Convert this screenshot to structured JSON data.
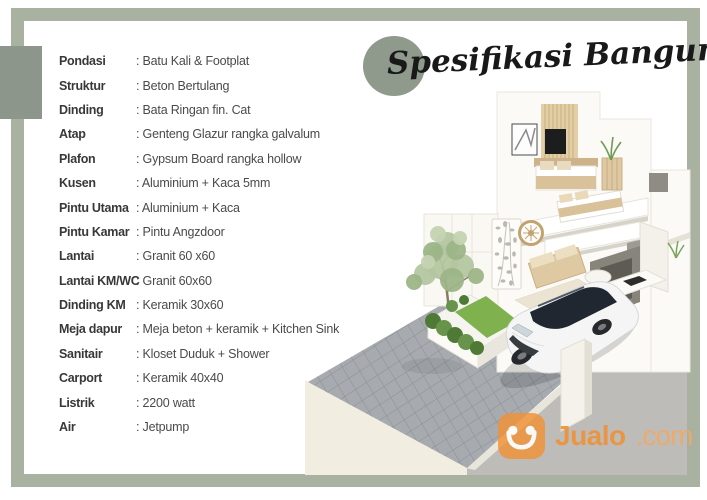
{
  "colors": {
    "frame_sage": "#a9b1a0",
    "accent_block": "#8d968b",
    "title_circle": "#8f9a8d",
    "jualo_orange": "#f09137",
    "jualo_orange_light": "#f3a963"
  },
  "title": {
    "text": "Spesifikasi Bangunan"
  },
  "specs": [
    {
      "label": "Pondasi",
      "value": ": Batu Kali & Footplat"
    },
    {
      "label": "Struktur",
      "value": ": Beton Bertulang"
    },
    {
      "label": "Dinding",
      "value": ": Bata Ringan fin. Cat"
    },
    {
      "label": "Atap",
      "value": ": Genteng Glazur rangka galvalum"
    },
    {
      "label": "Plafon",
      "value": ": Gypsum Board rangka hollow"
    },
    {
      "label": "Kusen",
      "value": ": Aluminium + Kaca 5mm"
    },
    {
      "label": "Pintu Utama",
      "value": ": Aluminium + Kaca"
    },
    {
      "label": "Pintu Kamar",
      "value": ": Pintu Angzdoor"
    },
    {
      "label": "Lantai",
      "value": ": Granit 60 x60"
    },
    {
      "label": "Lantai KM/WC",
      "value": ": Granit 60x60"
    },
    {
      "label": "Dinding KM",
      "value": ": Keramik 30x60"
    },
    {
      "label": "Meja dapur",
      "value": ": Meja beton + keramik + Kitchen Sink"
    },
    {
      "label": "Sanitair",
      "value": ": Kloset Duduk + Shower"
    },
    {
      "label": "Carport",
      "value": ": Keramik 40x40"
    },
    {
      "label": "Listrik",
      "value": ": 2200 watt"
    },
    {
      "label": "Air",
      "value": ": Jetpump"
    }
  ],
  "watermark": {
    "brand": "Jualo",
    "tld": ".com",
    "icon": "jualo-bag-smile-icon"
  },
  "scene": {
    "description": "3D isometric cutaway render of a two-storey minimalist house with furnished bedrooms, living room, carved partition panel, small tree in a planter, grey paver driveway and a white SUV parked in the carport"
  }
}
